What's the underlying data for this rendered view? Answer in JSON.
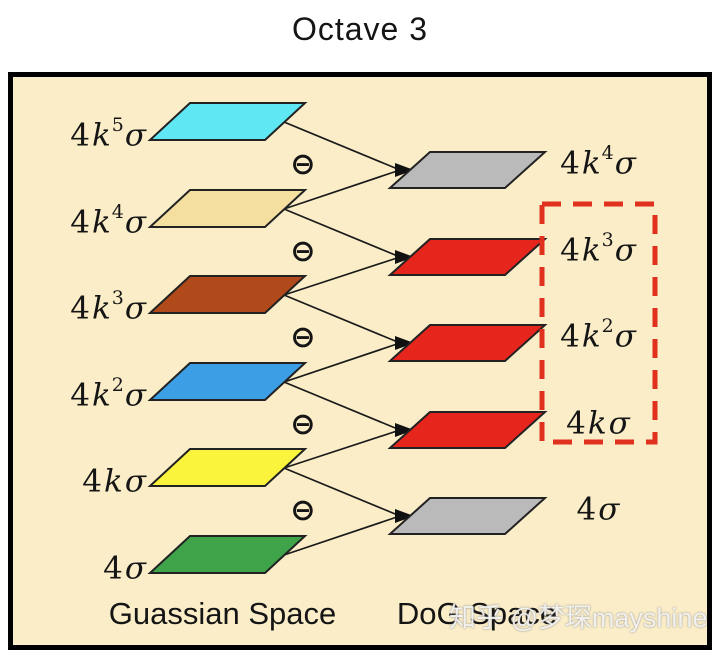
{
  "title": "Octave 3",
  "operator": {
    "minus": "⊖"
  },
  "colors": {
    "background": "#FAEDC8",
    "box_border": "#000000",
    "line": "#1a1a1a",
    "dash_box": "#E0301E"
  },
  "gaussian_space": {
    "caption": "Guassian Space",
    "levels": [
      {
        "num": "4",
        "k": "k",
        "sup": "5",
        "sigma": "σ",
        "color": "#5FE8F4",
        "name": "cyan"
      },
      {
        "num": "4",
        "k": "k",
        "sup": "4",
        "sigma": "σ",
        "color": "#F4DFA0",
        "name": "wheat"
      },
      {
        "num": "4",
        "k": "k",
        "sup": "3",
        "sigma": "σ",
        "color": "#B04A1A",
        "name": "brown"
      },
      {
        "num": "4",
        "k": "k",
        "sup": "2",
        "sigma": "σ",
        "color": "#3C9EE4",
        "name": "blue"
      },
      {
        "num": "4",
        "k": "k",
        "sup": "",
        "sigma": "σ",
        "color": "#FAF53C",
        "name": "yellow"
      },
      {
        "num": "4",
        "k": "",
        "sup": "",
        "sigma": "σ",
        "color": "#3EA349",
        "name": "green"
      }
    ]
  },
  "dog_space": {
    "caption": "DoG Space",
    "levels": [
      {
        "num": "4",
        "k": "k",
        "sup": "4",
        "sigma": "σ",
        "color": "#BABABA",
        "name": "gray",
        "highlighted": false
      },
      {
        "num": "4",
        "k": "k",
        "sup": "3",
        "sigma": "σ",
        "color": "#E6251D",
        "name": "red",
        "highlighted": true
      },
      {
        "num": "4",
        "k": "k",
        "sup": "2",
        "sigma": "σ",
        "color": "#E6251D",
        "name": "red",
        "highlighted": true
      },
      {
        "num": "4",
        "k": "k",
        "sup": "",
        "sigma": "σ",
        "color": "#E6251D",
        "name": "red",
        "highlighted": true
      },
      {
        "num": "4",
        "k": "",
        "sup": "",
        "sigma": "σ",
        "color": "#BABABA",
        "name": "gray",
        "highlighted": false
      }
    ]
  },
  "watermark": "知乎 @梦琛mayshine"
}
